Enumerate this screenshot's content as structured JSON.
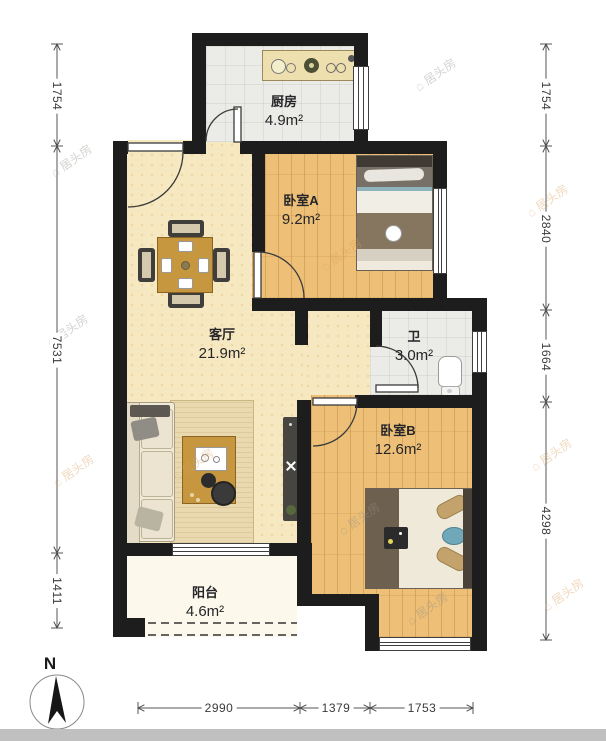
{
  "rooms": {
    "kitchen": {
      "name": "厨房",
      "area": "4.9m²"
    },
    "bedroom_a": {
      "name": "卧室A",
      "area": "9.2m²"
    },
    "living": {
      "name": "客厅",
      "area": "21.9m²"
    },
    "bath": {
      "name": "卫",
      "area": "3.0m²"
    },
    "bedroom_b": {
      "name": "卧室B",
      "area": "12.6m²"
    },
    "balcony": {
      "name": "阳台",
      "area": "4.6m²"
    }
  },
  "dimensions": {
    "left": [
      "1754",
      "7531",
      "1411"
    ],
    "right": [
      "1754",
      "2840",
      "1664",
      "4298"
    ],
    "bottom": [
      "2990",
      "1379",
      "1753"
    ]
  },
  "compass": {
    "north_label": "N"
  },
  "watermark": {
    "text": "居头房"
  },
  "colors": {
    "wall": "#1d1d1d",
    "living_floor": "#f6e8c0",
    "wood_floor": "#edbf77",
    "tile_floor": "#ebebe7",
    "balcony_floor": "#fcf9ec"
  }
}
